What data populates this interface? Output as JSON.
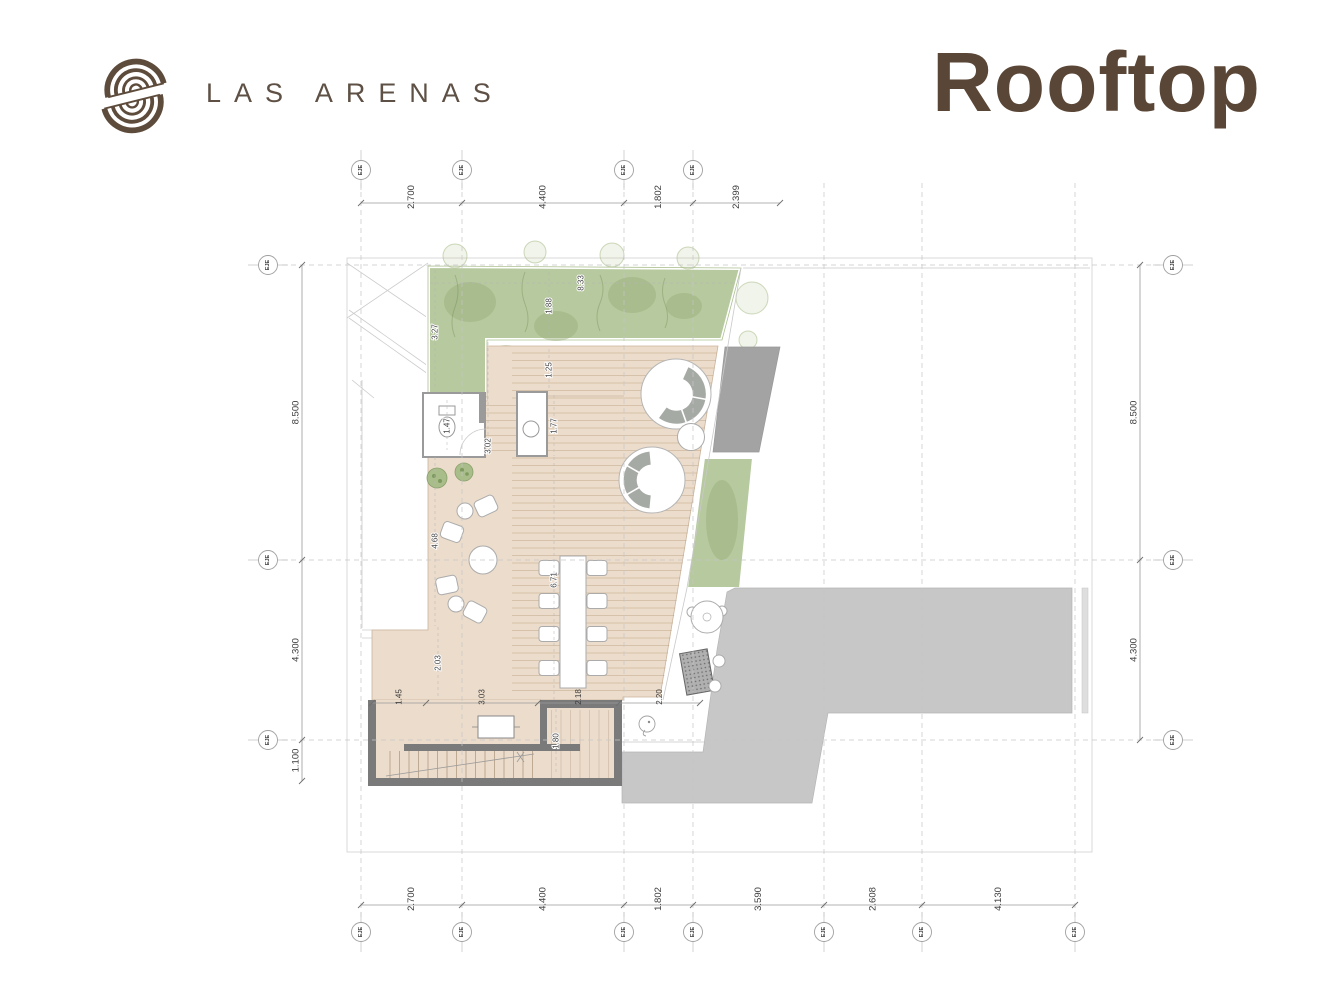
{
  "header": {
    "brand": "LAS ARENAS",
    "title": "Rooftop"
  },
  "colors": {
    "brand": "#5e5044",
    "title": "#5a4636",
    "green": "#b7c99e",
    "green-dark": "#96ad77",
    "beige": "#ecdccb",
    "gray-big": "#c7c7c7",
    "gray-dark": "#a3a3a3",
    "wall": "#7a7a7a"
  },
  "plan": {
    "grid": {
      "cols": [
        361,
        462,
        624,
        693,
        824,
        922,
        1075
      ],
      "col_y": [
        183,
        926
      ],
      "rows": [
        265,
        560,
        740
      ],
      "row_x": [
        282,
        1160
      ]
    },
    "chains": [
      {
        "id": "top",
        "o": "h",
        "pos": 203,
        "pts": [
          361,
          462,
          624,
          693,
          780
        ],
        "labels": [
          "2.700",
          "4.400",
          "1.802",
          "2.399"
        ],
        "cls": ""
      },
      {
        "id": "bottom",
        "o": "h",
        "pos": 905,
        "pts": [
          361,
          462,
          624,
          693,
          824,
          922,
          1075
        ],
        "labels": [
          "2.700",
          "4.400",
          "1.802",
          "3.590",
          "2.608",
          "4.130"
        ],
        "cls": ""
      },
      {
        "id": "left",
        "o": "v",
        "pos": 302,
        "pts": [
          265,
          560,
          740,
          781
        ],
        "labels": [
          "8.500",
          "4.300",
          "1.100"
        ],
        "cls": ""
      },
      {
        "id": "right",
        "o": "v",
        "pos": 1140,
        "pts": [
          265,
          560,
          740
        ],
        "labels": [
          "8.500",
          "4.300"
        ],
        "cls": ""
      },
      {
        "id": "stairs",
        "o": "h",
        "pos": 703,
        "pts": [
          372,
          426,
          538,
          619,
          700
        ],
        "labels": [
          "1.45",
          "3.03",
          "2.18",
          "2.20"
        ],
        "cls": "small"
      }
    ],
    "interior_dims": [
      {
        "label": "3.27",
        "x": 435,
        "y": 332,
        "line": [
          435,
          270,
          435,
          390
        ]
      },
      {
        "label": "8.33",
        "x": 581,
        "y": 283,
        "line": [
          430,
          283,
          734,
          283
        ]
      },
      {
        "label": "1.88",
        "x": 549,
        "y": 306,
        "line": [
          549,
          272,
          549,
          338
        ]
      },
      {
        "label": "1.25",
        "x": 549,
        "y": 370,
        "line": [
          549,
          349,
          549,
          391
        ]
      },
      {
        "label": "1.77",
        "x": 554,
        "y": 426,
        "line": [
          554,
          395,
          554,
          456
        ]
      },
      {
        "label": "1.47",
        "x": 447,
        "y": 426,
        "line": [
          447,
          400,
          447,
          450
        ]
      },
      {
        "label": "3.02",
        "x": 488,
        "y": 446,
        "line": [
          488,
          342,
          488,
          450
        ]
      },
      {
        "label": "4.68",
        "x": 435,
        "y": 541,
        "line": [
          435,
          457,
          435,
          626
        ]
      },
      {
        "label": "6.71",
        "x": 554,
        "y": 580,
        "line": [
          554,
          457,
          554,
          700
        ]
      },
      {
        "label": "2.03",
        "x": 438,
        "y": 663,
        "line": [
          438,
          627,
          438,
          698
        ]
      },
      {
        "label": "1.80",
        "x": 556,
        "y": 741,
        "line": [
          556,
          709,
          556,
          772
        ]
      }
    ],
    "axes": {
      "label": "EJE",
      "markers": [
        {
          "x": 361,
          "y": 170,
          "d": "v"
        },
        {
          "x": 462,
          "y": 170,
          "d": "v"
        },
        {
          "x": 624,
          "y": 170,
          "d": "v"
        },
        {
          "x": 693,
          "y": 170,
          "d": "v"
        },
        {
          "x": 361,
          "y": 932,
          "d": "v"
        },
        {
          "x": 462,
          "y": 932,
          "d": "v"
        },
        {
          "x": 624,
          "y": 932,
          "d": "v"
        },
        {
          "x": 693,
          "y": 932,
          "d": "v"
        },
        {
          "x": 824,
          "y": 932,
          "d": "v"
        },
        {
          "x": 922,
          "y": 932,
          "d": "v"
        },
        {
          "x": 1075,
          "y": 932,
          "d": "v"
        },
        {
          "x": 268,
          "y": 265,
          "d": "h"
        },
        {
          "x": 268,
          "y": 560,
          "d": "h"
        },
        {
          "x": 268,
          "y": 740,
          "d": "h"
        },
        {
          "x": 1173,
          "y": 265,
          "d": "h"
        },
        {
          "x": 1173,
          "y": 560,
          "d": "h"
        },
        {
          "x": 1173,
          "y": 740,
          "d": "h"
        }
      ]
    }
  }
}
